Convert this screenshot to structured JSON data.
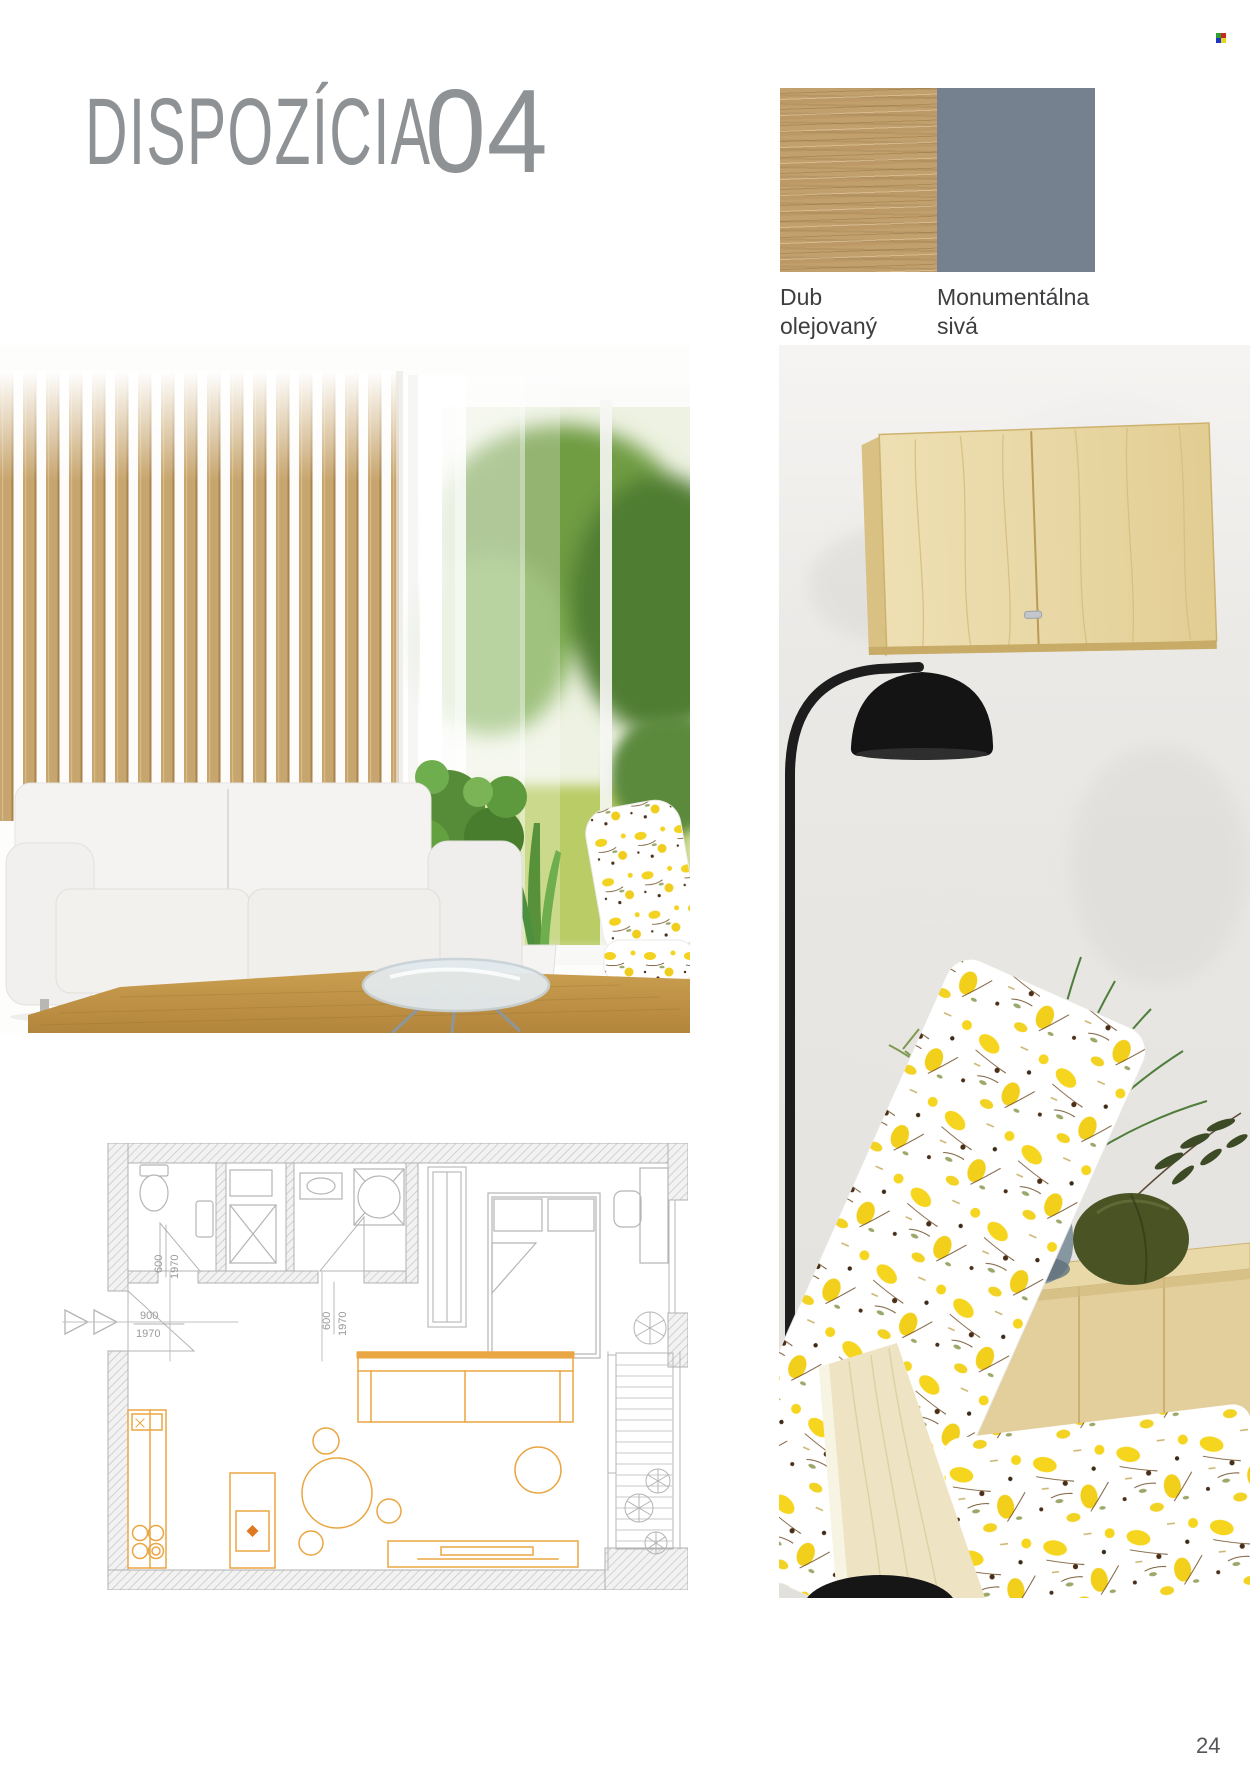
{
  "page": {
    "number": "24",
    "background": "#ffffff"
  },
  "header": {
    "title": "DISPOZÍCIA",
    "number": "04",
    "color": "#8f9295"
  },
  "system_icon": {
    "name": "color-grid-icon",
    "colors": [
      "#2f9e33",
      "#c8291f",
      "#1f35c8",
      "#e5d51c"
    ]
  },
  "materials": {
    "label_color": "#3e3e40",
    "items": [
      {
        "id": "dub-olejovany",
        "label_line1": "Dub",
        "label_line2": "olejovaný",
        "swatch": "wood",
        "base_color": "#c2a06d"
      },
      {
        "id": "monumentalna-siva",
        "label_line1": "Monumentálna",
        "label_line2": "sivá",
        "swatch": "solid",
        "base_color": "#76818f"
      }
    ]
  },
  "floor_plan": {
    "line_color": "#b5b5b5",
    "accent_color": "#eaa643",
    "dims": {
      "entrance": {
        "w": "900",
        "h": "1970"
      },
      "door_wc": {
        "w": "600",
        "h": "1970"
      },
      "door_shower": {
        "w": "600",
        "h": "1970"
      }
    }
  }
}
